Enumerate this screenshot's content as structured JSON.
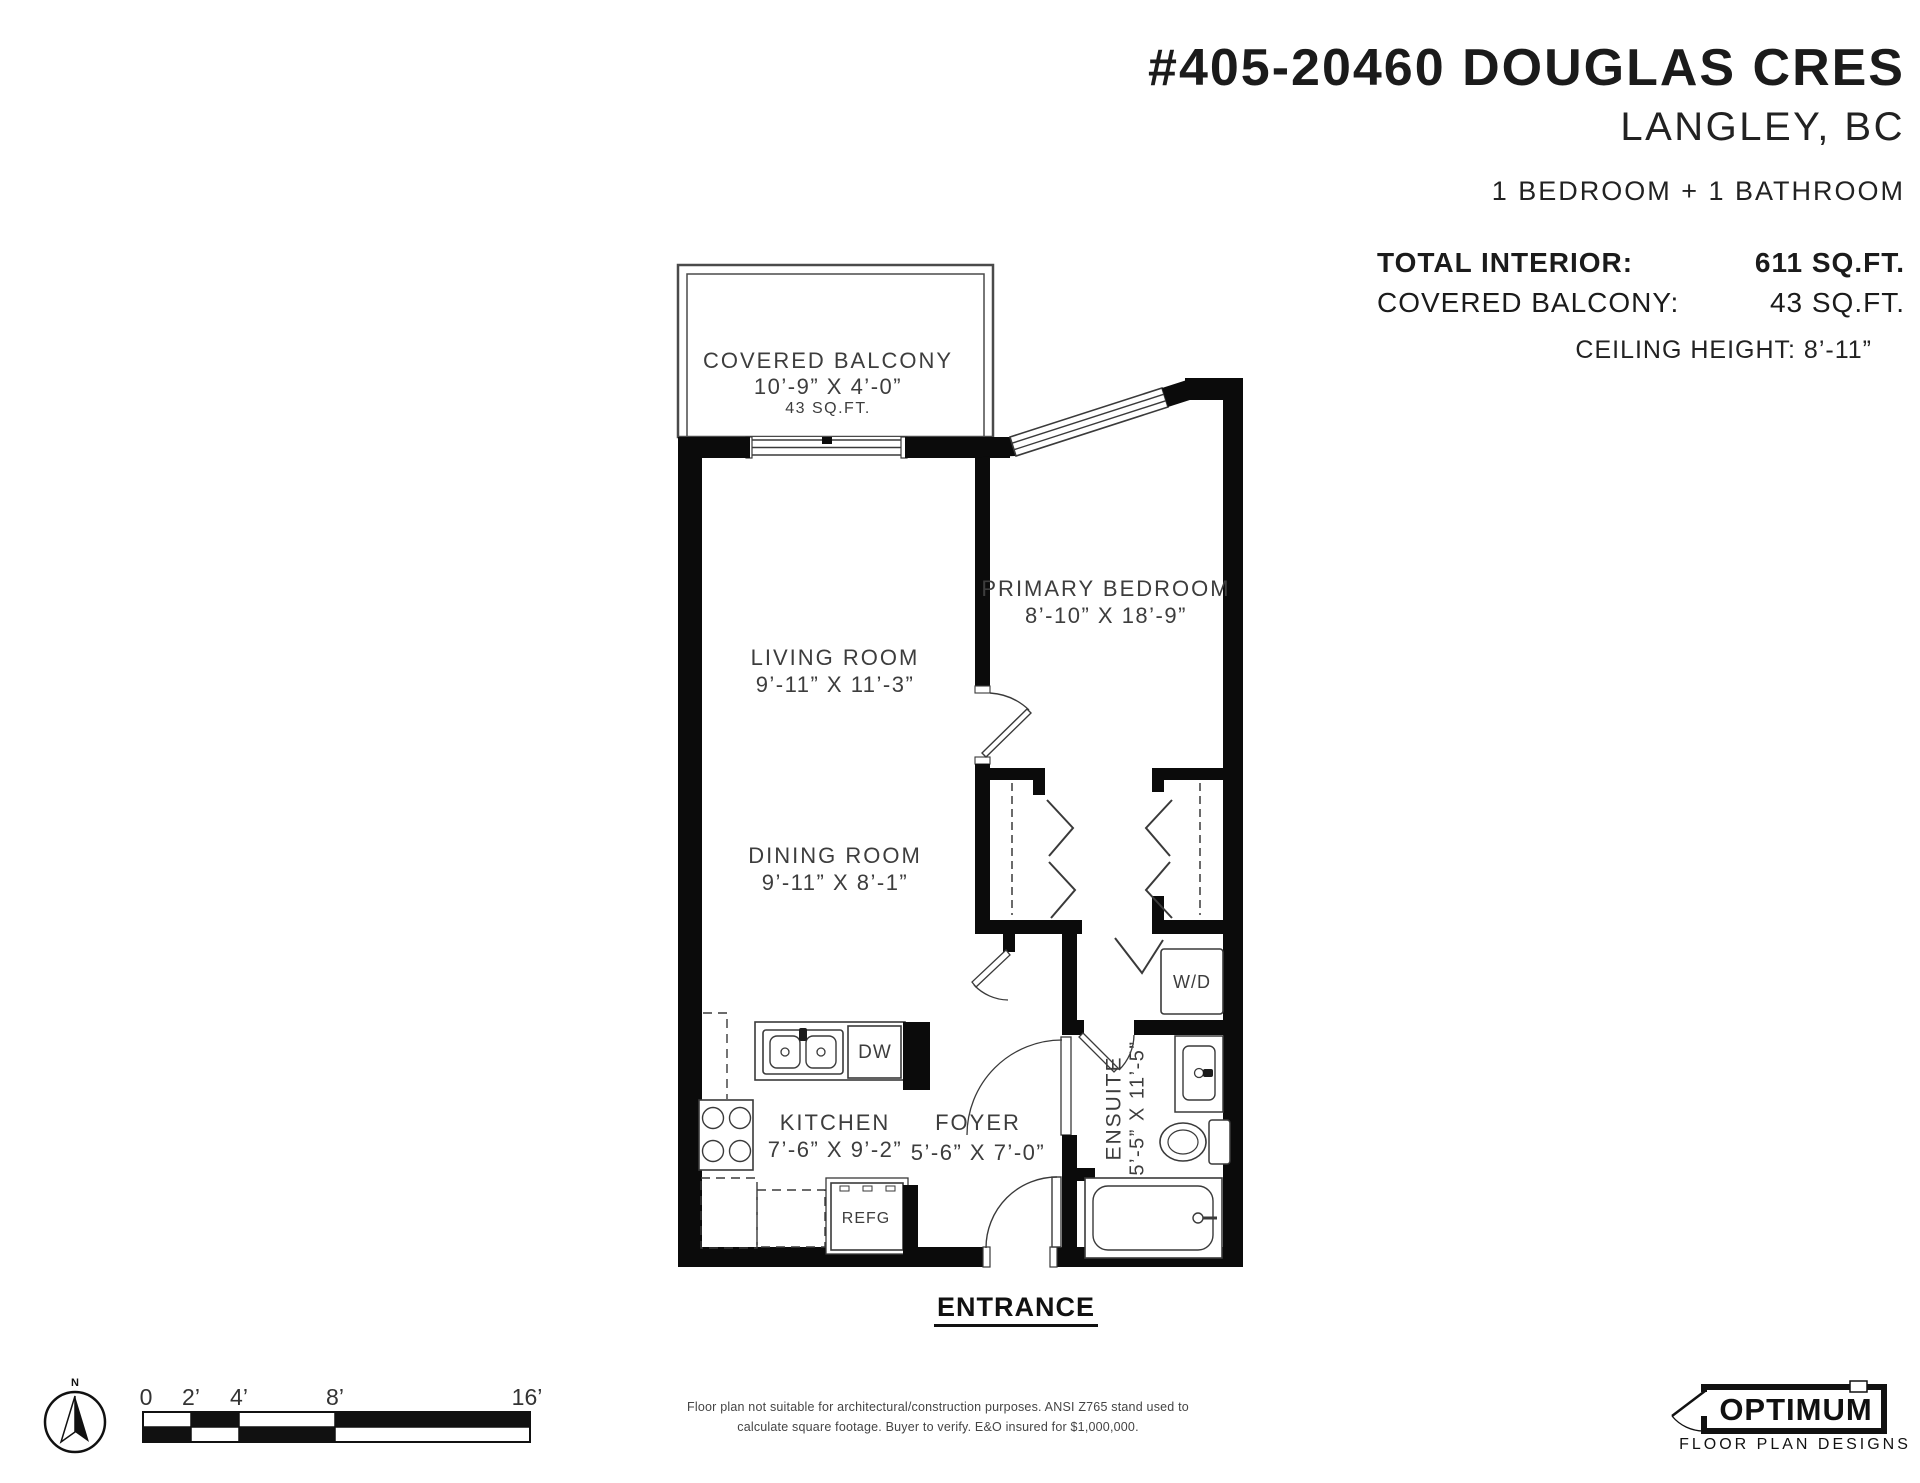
{
  "header": {
    "title": "#405-20460 DOUGLAS CRES",
    "city": "LANGLEY, BC",
    "config": "1 BEDROOM + 1 BATHROOM",
    "total_interior_label": "TOTAL INTERIOR:",
    "total_interior_value": "611 SQ.FT.",
    "balcony_label": "COVERED BALCONY:",
    "balcony_value": "43 SQ.FT.",
    "ceiling": "CEILING HEIGHT: 8’-11”"
  },
  "plan": {
    "rooms": {
      "balcony": {
        "name": "COVERED BALCONY",
        "dims": "10’-9” X 4’-0”",
        "area": "43 SQ.FT."
      },
      "living": {
        "name": "LIVING ROOM",
        "dims": "9’-11” X 11’-3”"
      },
      "bedroom": {
        "name": "PRIMARY BEDROOM",
        "dims": "8’-10” X 18’-9”"
      },
      "dining": {
        "name": "DINING ROOM",
        "dims": "9’-11” X 8’-1”"
      },
      "kitchen": {
        "name": "KITCHEN",
        "dims": "7’-6” X 9’-2”"
      },
      "foyer": {
        "name": "FOYER",
        "dims": "5’-6” X 7’-0”"
      },
      "ensuite": {
        "name": "ENSUITE",
        "dims": "5’-5” X 11’-5”"
      }
    },
    "fixtures": {
      "washer_dryer": "W/D",
      "dishwasher": "DW",
      "refrigerator": "REFG"
    },
    "entrance": "ENTRANCE"
  },
  "footer": {
    "compass_label": "N",
    "scale_ticks": [
      "0",
      "2’",
      "4’",
      "8’",
      "16’"
    ],
    "disclaimer_line1": "Floor plan not suitable for architectural/construction purposes. ANSI Z765 stand used to",
    "disclaimer_line2": "calculate square footage. Buyer to verify.  E&O insured for $1,000,000.",
    "logo_name": "OPTIMUM",
    "logo_tagline": "FLOOR PLAN DESIGNS"
  }
}
